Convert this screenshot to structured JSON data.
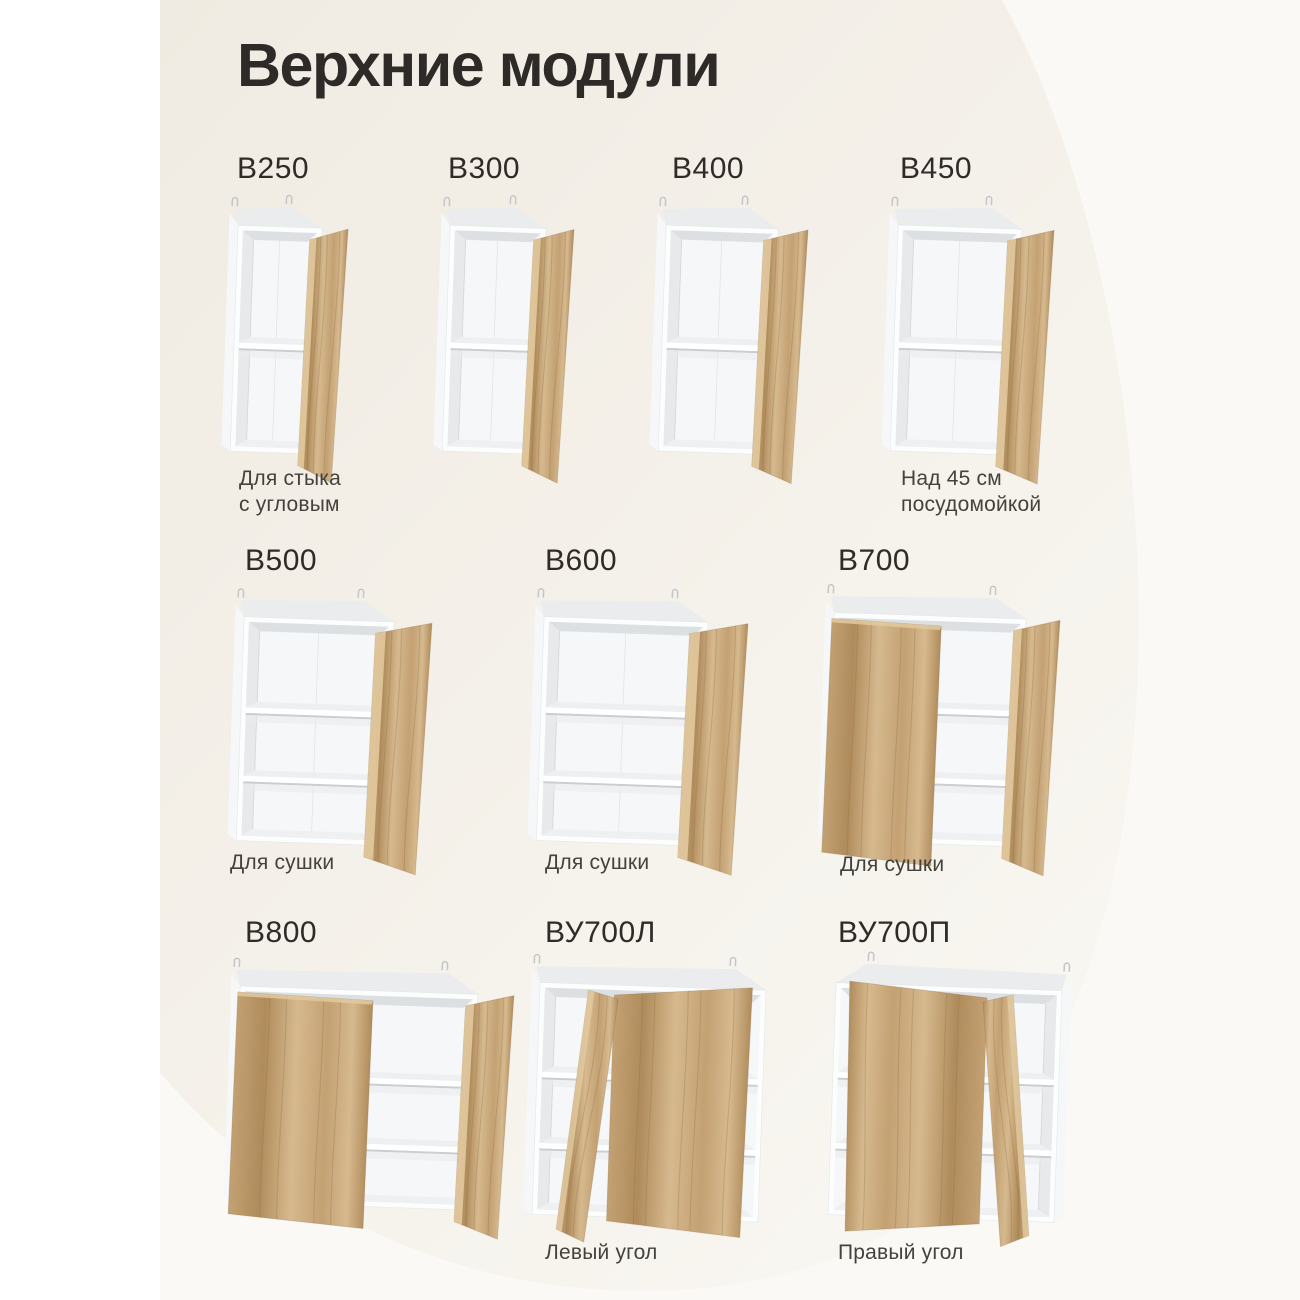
{
  "page": {
    "title": "Верхние модули"
  },
  "modules": [
    {
      "code": "В250",
      "caption": "Для стыка\nс угловым"
    },
    {
      "code": "В300",
      "caption": ""
    },
    {
      "code": "В400",
      "caption": ""
    },
    {
      "code": "В450",
      "caption": "Над 45 см\nпосудомойкой"
    },
    {
      "code": "В500",
      "caption": "Для сушки"
    },
    {
      "code": "В600",
      "caption": "Для сушки"
    },
    {
      "code": "В700",
      "caption": "Для сушки"
    },
    {
      "code": "В800",
      "caption": ""
    },
    {
      "code": "ВУ700Л",
      "caption": "Левый угол"
    },
    {
      "code": "ВУ700П",
      "caption": "Правый угол"
    }
  ],
  "colors": {
    "title": "#2e2a27",
    "code": "#2f2b28",
    "caption": "#45413d",
    "blob_top": "#f0ebe2",
    "blob_bottom": "#f9f7f2",
    "outer_bg": "#fbf9f6",
    "left_strip": "#ffffff",
    "wood_light": "#d6b98e",
    "wood_mid": "#c3a173",
    "wood_deep": "#b08c5c",
    "wood_dark": "#8a6b43",
    "wood_edge": "#e2c99f",
    "carcass": "#fcfdfd"
  }
}
